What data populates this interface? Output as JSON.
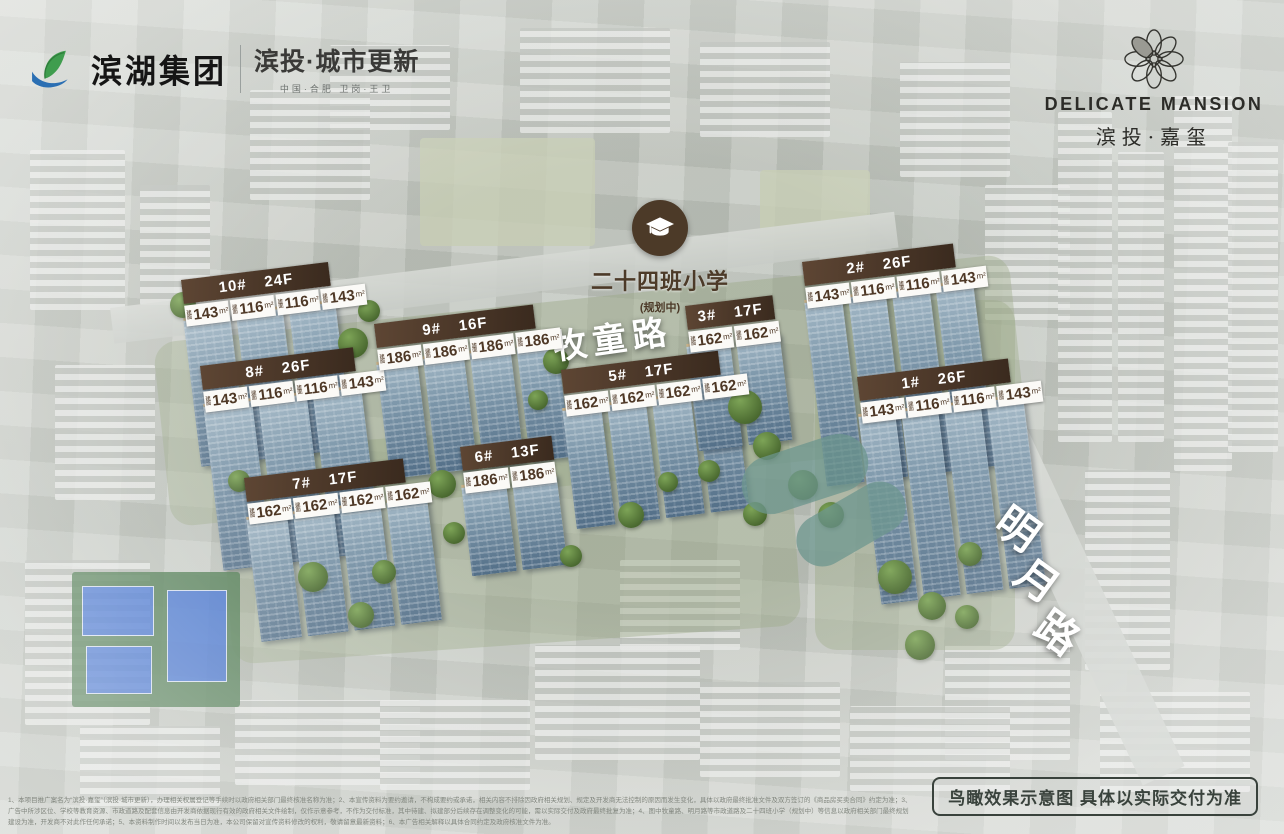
{
  "brand_bar": {
    "left": {
      "group_name": "滨湖集团",
      "sub_brand": "滨投·城市更新",
      "tagline": "中国·合肥  卫岗·王卫"
    },
    "right": {
      "name_en": "DELICATE MANSION",
      "name_cn": "滨投·嘉玺"
    }
  },
  "school_marker": {
    "title": "二十四班小学",
    "status": "(规划中)"
  },
  "roads": [
    {
      "name": "牧童路"
    },
    {
      "name": "明月路"
    }
  ],
  "unit_prefix": "建面",
  "unit_suffix": "m²",
  "buildings": [
    {
      "id": "10#",
      "floors": "24F",
      "units": [
        "143",
        "116",
        "116",
        "143"
      ]
    },
    {
      "id": "8#",
      "floors": "26F",
      "units": [
        "143",
        "116",
        "116",
        "143"
      ]
    },
    {
      "id": "9#",
      "floors": "16F",
      "units": [
        "186",
        "186",
        "186",
        "186"
      ]
    },
    {
      "id": "5#",
      "floors": "17F",
      "units": [
        "162",
        "162",
        "162",
        "162"
      ]
    },
    {
      "id": "3#",
      "floors": "17F",
      "units": [
        "162",
        "162"
      ]
    },
    {
      "id": "2#",
      "floors": "26F",
      "units": [
        "143",
        "116",
        "116",
        "143"
      ]
    },
    {
      "id": "1#",
      "floors": "26F",
      "units": [
        "143",
        "116",
        "116",
        "143"
      ]
    },
    {
      "id": "6#",
      "floors": "13F",
      "units": [
        "186",
        "186"
      ]
    },
    {
      "id": "7#",
      "floors": "17F",
      "units": [
        "162",
        "162",
        "162",
        "162"
      ]
    }
  ],
  "footer": {
    "disclaimer": "1、本项目推广案名为“滨投·嘉玺”（滨投·城市更新），办理相关权属登记等手续时以政府相关部门最终核准名称为准；2、本宣传资料为要约邀请，不构成要约或承诺，相关内容不排除因政府相关规划、规定及开发商无法控制的原因而发生变化，具体以政府最终批准文件及双方签订的《商品房买卖合同》约定为准；3、广告中所涉区位、学校等教育资源、市政道路及配套信息由开发商依据现行有效的政府相关文件绘制，仅作示意参考，不作为交付标准，其中待建、拟建部分后续存在调整变化的可能，需以实际交付及政府最终批复为准；4、图中牧童路、明月路等市政道路及二十四班小学（规划中）等信息以政府相关部门最终规划建设为准，开发商不对此作任何承诺；5、本资料制作时间以发布当日为准，本公司保留对宣传资料修改的权利，敬请留意最新资料；6、本广告相关解释以具体合同约定及政府核准文件为准。",
    "note": "鸟瞰效果示意图  具体以实际交付为准"
  },
  "colors": {
    "banner_brown": "#4a3526",
    "logo_green": "#3f9d4e",
    "logo_blue": "#2b6fb3",
    "road_text": "#ffffff",
    "note_text": "#39423c"
  }
}
